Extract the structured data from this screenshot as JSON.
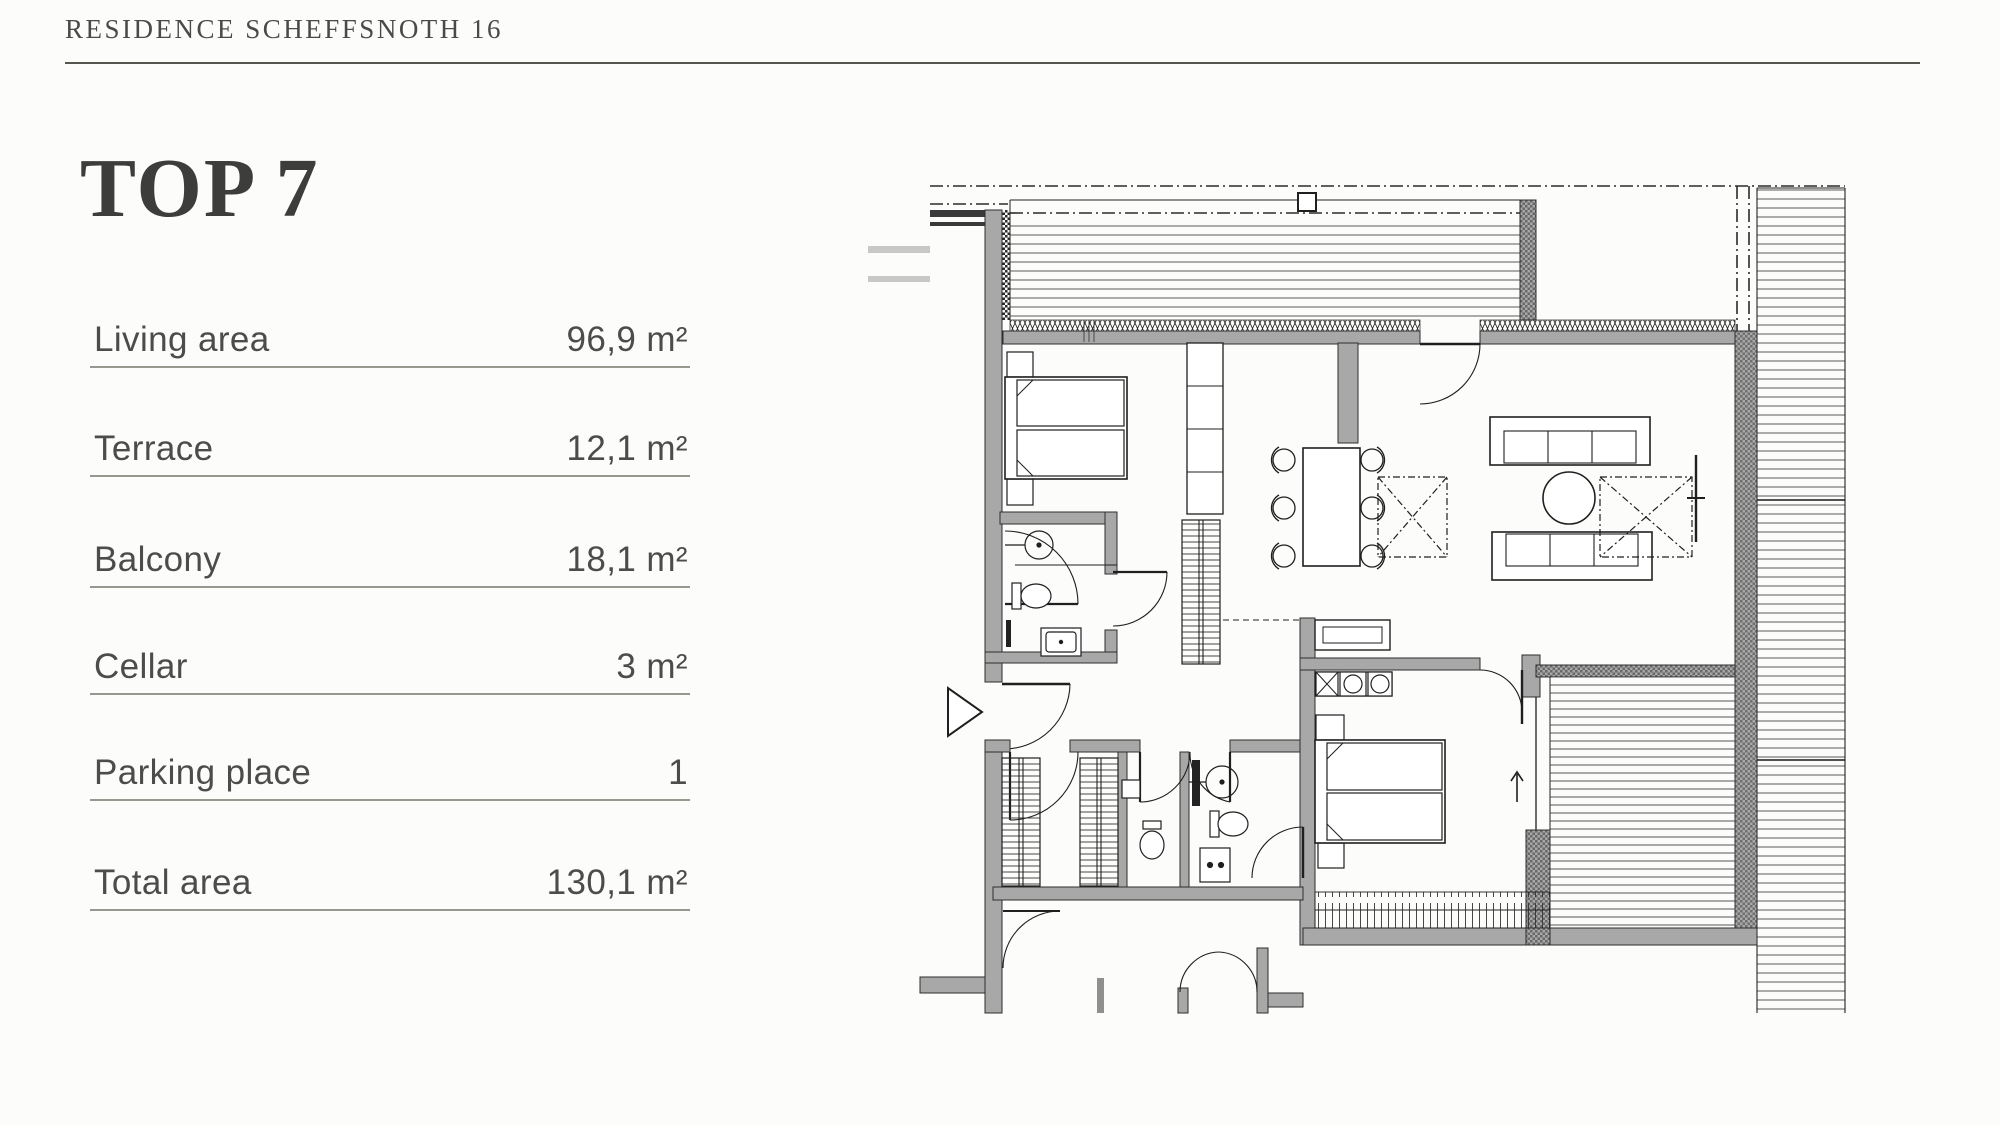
{
  "header": {
    "title": "RESIDENCE SCHEFFSNOTH 16"
  },
  "unit": {
    "title": "TOP 7"
  },
  "specs": {
    "rows": [
      {
        "label": "Living area",
        "value": "96,9 m²"
      },
      {
        "label": "Terrace",
        "value": "12,1 m²"
      },
      {
        "label": "Balcony",
        "value": "18,1 m²"
      },
      {
        "label": "Cellar",
        "value": "3 m²"
      },
      {
        "label": "Parking place",
        "value": "1"
      },
      {
        "label": "Total area",
        "value": "130,1 m²"
      }
    ]
  },
  "floorplan": {
    "name": "apartment-top-7-floor-plan",
    "features": [
      "terrace-decking",
      "right-walkway-decking",
      "balcony-decking",
      "bedroom-1",
      "bathroom-1",
      "wardrobes",
      "dining-table-six-chairs",
      "living-sofas",
      "kitchen-counter",
      "bedroom-2",
      "bathroom-2",
      "wc",
      "entrance-arrow",
      "direction-arrow-up"
    ]
  },
  "colors": {
    "text": "#4a4a48",
    "title": "#3d3d3b",
    "rule": "#55554f",
    "row_line": "#97978f",
    "wall": "#a8a8a8",
    "background": "#fcfcfb"
  }
}
